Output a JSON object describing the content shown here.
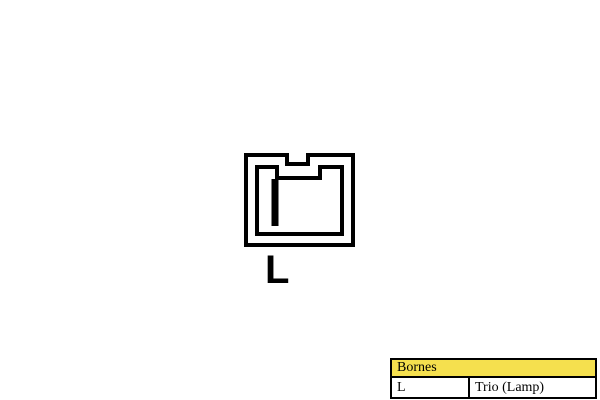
{
  "page": {
    "background": "#FFFFFF"
  },
  "diagram": {
    "type": "connector-pinout",
    "pin_label": "L",
    "line_color": "#000000"
  },
  "legend_table": {
    "header": "Bornes",
    "header_bg": "#F5E04E",
    "border_color": "#000000",
    "rows": [
      {
        "terminal": "L",
        "function": "Trio (Lamp)"
      }
    ]
  }
}
